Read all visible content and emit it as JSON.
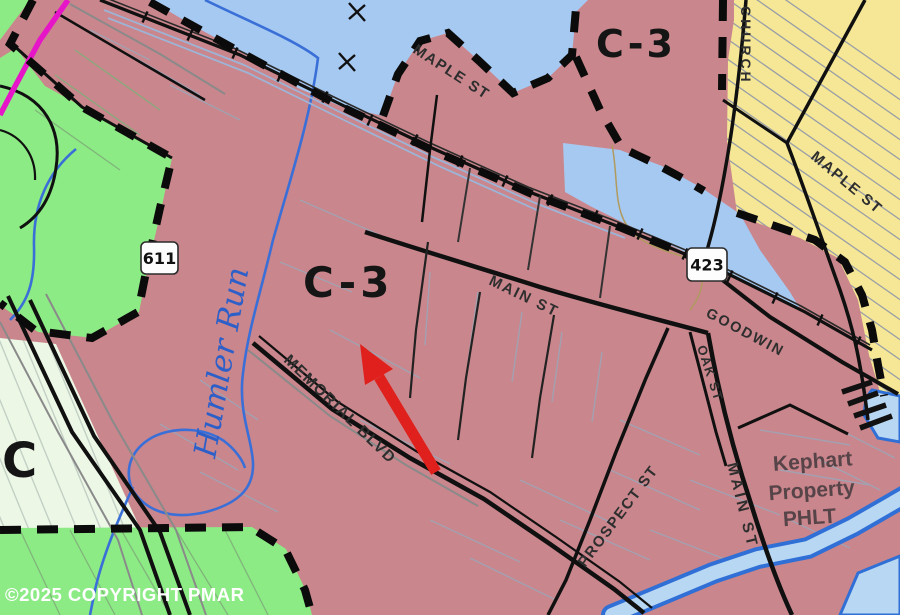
{
  "map": {
    "type": "municipal zoning map",
    "region_labels": {
      "c3_center": "C-3",
      "c3_top_right": "C-3",
      "c_left": "C"
    },
    "streets": {
      "maple_st_top": "MAPLE ST",
      "maple_st_right": "MAPLE ST",
      "church": "CHURCH",
      "main_st": "MAIN ST",
      "main_st_south": "MAIN ST",
      "goodwin": "GOODWIN",
      "oak_st": "OAK ST",
      "prospect_st": "PROSPECT ST",
      "memorial_blvd": "MEMORIAL BLVD"
    },
    "route_markers": {
      "route_611": "611",
      "route_423": "423"
    },
    "water": {
      "humler_run": "Humler Run"
    },
    "property": {
      "line1": "Kephart",
      "line2": "Property",
      "line3": "PHLT"
    },
    "annotations": {
      "copyright": "©2025 COPYRIGHT PMAR"
    },
    "colors": {
      "commercial_c3": "#c9868c",
      "residential_green": "#8ceb85",
      "pale_zone": "#ecf7e6",
      "institutional_yellow": "#f5e795",
      "water_zone": "#a6c9f1",
      "pond_fill": "#b8d7f2",
      "pond_outline": "#2f6fd6",
      "stream": "#3a6fd8",
      "boundary_magenta": "#e616c8",
      "road_black": "#101010",
      "arrow_red": "#e0201c"
    }
  }
}
